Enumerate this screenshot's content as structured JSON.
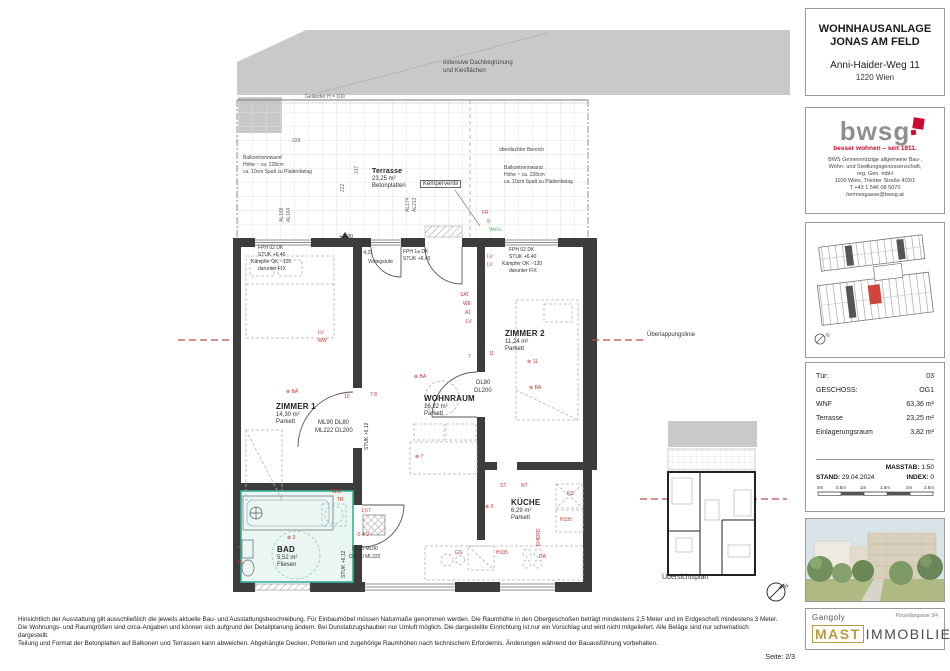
{
  "title_block": {
    "line1": "WOHNHAUSANLAGE",
    "line2": "JONAS AM FELD",
    "address1": "Anni-Haider-Weg 11",
    "address2": "1220 Wien"
  },
  "bwsg": {
    "logo_text": "bwsg",
    "tagline": "besser wohnen – seit 1911.",
    "desc1": "BWS Gemeinnützige allgemeine Bau-,",
    "desc2": "Wohn- und Siedlungsgenossenschaft,",
    "desc3": "reg. Gen. mbH",
    "desc4": "1100 Wien, Triester Straße 403/1",
    "desc5": "T +43 1 546 08 5070",
    "desc6": "hermesgasse@bwsg.at"
  },
  "unit_info": {
    "rows": [
      {
        "label": "Tür:",
        "value": "03"
      },
      {
        "label": "GESCHOSS:",
        "value": "OG1"
      },
      {
        "label": "WNF",
        "value": "63,36 m²"
      },
      {
        "label": "Terrasse",
        "value": "23,25 m²"
      },
      {
        "label": "Einlagerungsraum",
        "value": "3,82 m²"
      }
    ]
  },
  "plan_meta": {
    "masstab_label": "MASSTAB:",
    "masstab": "1:50",
    "stand_label": "STAND:",
    "stand": "29.04.2024",
    "index_label": "INDEX:",
    "index": "0",
    "scale_ticks": [
      "0m",
      "0.5m",
      "1m",
      "1.5m",
      "2m",
      "2.5m"
    ]
  },
  "brand": {
    "architect": "Gangoly",
    "address": "Porzellangasse 3/4",
    "brand_primary": "MAST",
    "brand_secondary": "IMMOBILIEN"
  },
  "rooms": [
    {
      "name": "ZIMMER 1",
      "area": "14,30 m²",
      "floor": "Parkett"
    },
    {
      "name": "WOHNRAUM",
      "area": "16,22 m²",
      "floor": "Parkett"
    },
    {
      "name": "ZIMMER 2",
      "area": "11,24 m²",
      "floor": "Parkett"
    },
    {
      "name": "KÜCHE",
      "area": "6,29 m²",
      "floor": "Parkett"
    },
    {
      "name": "BAD",
      "area": "5,52 m²",
      "floor": "Fliesen"
    },
    {
      "name": "Terrasse",
      "area": "23,25 m²",
      "floor": "Betonplatten"
    }
  ],
  "colors": {
    "annotation_red": "#c2382f",
    "overlap_red": "#bf4a44",
    "bad_teal": "#37b09c",
    "bwsg_red": "#cc0a2f",
    "mast_gold": "#b99a3e",
    "wall_dark": "#3c3c3c"
  },
  "plan": {
    "annotations": [
      {
        "t": "LV",
        "x": 487,
        "y": 254
      },
      {
        "t": "LV",
        "x": 487,
        "y": 262
      },
      {
        "t": "SAT",
        "x": 460,
        "y": 292
      },
      {
        "t": "WE",
        "x": 463,
        "y": 301
      },
      {
        "t": "A1",
        "x": 465,
        "y": 310
      },
      {
        "t": "LV",
        "x": 466,
        "y": 319
      },
      {
        "t": "LV",
        "x": 318,
        "y": 330
      },
      {
        "t": "MW",
        "x": 318,
        "y": 338
      },
      {
        "t": "⊗ BA",
        "x": 286,
        "y": 389
      },
      {
        "t": "10",
        "x": 344,
        "y": 394
      },
      {
        "t": "7 8",
        "x": 370,
        "y": 392
      },
      {
        "t": "⊗ BA",
        "x": 414,
        "y": 374
      },
      {
        "t": "⊗ 7",
        "x": 415,
        "y": 454
      },
      {
        "t": "7",
        "x": 468,
        "y": 354
      },
      {
        "t": "11",
        "x": 489,
        "y": 351
      },
      {
        "t": "⊗ 11",
        "x": 527,
        "y": 359
      },
      {
        "t": "⊗ BA",
        "x": 529,
        "y": 385
      },
      {
        "t": "ST",
        "x": 500,
        "y": 483
      },
      {
        "t": "NT",
        "x": 521,
        "y": 483
      },
      {
        "t": "KS",
        "x": 567,
        "y": 491
      },
      {
        "t": "H105",
        "x": 560,
        "y": 517
      },
      {
        "t": "EHERD",
        "x": 536,
        "y": 546,
        "v": true
      },
      {
        "t": "GS",
        "x": 455,
        "y": 550
      },
      {
        "t": "H105",
        "x": 496,
        "y": 550
      },
      {
        "t": "DA",
        "x": 539,
        "y": 554
      },
      {
        "t": "⊗ 6",
        "x": 485,
        "y": 504
      },
      {
        "t": "WM",
        "x": 332,
        "y": 489
      },
      {
        "t": "TR",
        "x": 337,
        "y": 497
      },
      {
        "t": "⊗ 3",
        "x": 287,
        "y": 535
      },
      {
        "t": "4",
        "x": 238,
        "y": 545
      },
      {
        "t": "KL",
        "x": 238,
        "y": 560
      },
      {
        "t": "1,67",
        "x": 361,
        "y": 508
      },
      {
        "t": "-0,4 V",
        "x": 356,
        "y": 532
      },
      {
        "t": "FR",
        "x": 482,
        "y": 210
      },
      {
        "t": "9",
        "x": 487,
        "y": 219
      },
      {
        "t": "Ven-L",
        "x": 489,
        "y": 227,
        "c": "#3aa544"
      },
      {
        "t": "FPH 02  DK",
        "x": 258,
        "y": 245,
        "c": "#333"
      },
      {
        "t": "STUK +6,40",
        "x": 258,
        "y": 252,
        "c": "#333"
      },
      {
        "t": "Kämpfer OK ~120",
        "x": 251,
        "y": 259,
        "c": "#333"
      },
      {
        "t": "darunter FIX",
        "x": 258,
        "y": 266,
        "c": "#333"
      },
      {
        "t": "FPH 1a  DK",
        "x": 403,
        "y": 249,
        "c": "#333"
      },
      {
        "t": "STUK +6,40",
        "x": 403,
        "y": 256,
        "c": "#333"
      },
      {
        "t": "FPH 02  DK",
        "x": 509,
        "y": 247,
        "c": "#333"
      },
      {
        "t": "STUK +6,40",
        "x": 509,
        "y": 254,
        "c": "#333"
      },
      {
        "t": "Kämpfer OK ~120",
        "x": 502,
        "y": 261,
        "c": "#333"
      },
      {
        "t": "darunter FIX",
        "x": 509,
        "y": 268,
        "c": "#333"
      },
      {
        "t": "+ 4,21",
        "x": 359,
        "y": 250,
        "c": "#333"
      },
      {
        "t": "Vorlegstufe",
        "x": 368,
        "y": 259,
        "c": "#333"
      },
      {
        "t": "+ 4,20",
        "x": 339,
        "y": 234,
        "c": "#333"
      },
      {
        "t": "ML90  DL80",
        "x": 318,
        "y": 420,
        "c": "#333",
        "fs": 6
      },
      {
        "t": "ML222  DL200",
        "x": 315,
        "y": 428,
        "c": "#333",
        "fs": 6
      },
      {
        "t": "STUK +6,12",
        "x": 364,
        "y": 450,
        "c": "#333",
        "v": true
      },
      {
        "t": "DL80",
        "x": 476,
        "y": 380,
        "c": "#333",
        "fs": 6
      },
      {
        "t": "DL200",
        "x": 474,
        "y": 388,
        "c": "#333",
        "fs": 6
      },
      {
        "t": "DL80  ML90",
        "x": 352,
        "y": 546,
        "c": "#333"
      },
      {
        "t": "DL200  ML222",
        "x": 349,
        "y": 554,
        "c": "#333"
      },
      {
        "t": "STUK +6,12",
        "x": 341,
        "y": 578,
        "c": "#333",
        "v": true
      },
      {
        "t": "Geländer H = 100",
        "x": 305,
        "y": 94,
        "c": "#555"
      },
      {
        "t": "überdachter Bereich",
        "x": 499,
        "y": 147,
        "c": "#444"
      },
      {
        "t": "Balkontrennwand",
        "x": 243,
        "y": 155,
        "c": "#444"
      },
      {
        "t": "Höhe ~ ca. 228cm",
        "x": 243,
        "y": 162,
        "c": "#444"
      },
      {
        "t": "ca. 10cm Spalt zu Plattenbelag",
        "x": 243,
        "y": 169,
        "c": "#444"
      },
      {
        "t": "Balkontrennwand",
        "x": 504,
        "y": 165,
        "c": "#444"
      },
      {
        "t": "Höhe ~ ca. 228cm",
        "x": 504,
        "y": 172,
        "c": "#444"
      },
      {
        "t": "ca. 10cm Spalt zu Plattenbelag",
        "x": 504,
        "y": 179,
        "c": "#444"
      },
      {
        "t": "extensive Dachbegrünung",
        "x": 443,
        "y": 60,
        "c": "#444",
        "fs": 6
      },
      {
        "t": "und Kiesflächen",
        "x": 443,
        "y": 68,
        "c": "#444",
        "fs": 6
      },
      {
        "t": "229",
        "x": 292,
        "y": 138,
        "c": "#666"
      },
      {
        "t": "222",
        "x": 340,
        "y": 192,
        "c": "#666",
        "v": true
      },
      {
        "t": "317",
        "x": 354,
        "y": 174,
        "c": "#666",
        "v": true
      },
      {
        "t": "AL168",
        "x": 279,
        "y": 222,
        "c": "#666",
        "v": true
      },
      {
        "t": "AL164",
        "x": 286,
        "y": 222,
        "c": "#666",
        "v": true
      },
      {
        "t": "AL174",
        "x": 405,
        "y": 212,
        "c": "#666",
        "v": true
      },
      {
        "t": "AL213",
        "x": 412,
        "y": 212,
        "c": "#666",
        "v": true
      },
      {
        "t": "Kemperventil",
        "x": 420,
        "y": 180,
        "c": "#333",
        "fs": 6,
        "box": true
      },
      {
        "t": "Überlappungslinie",
        "x": 647,
        "y": 332,
        "c": "#333",
        "fs": 6
      },
      {
        "t": "Übersichtsplan",
        "x": 662,
        "y": 575,
        "c": "#333",
        "fs": 7
      }
    ]
  },
  "disclaimer": {
    "line1": "Hinsichtlich der Ausstattung gilt ausschließlich die jeweils aktuelle Bau- und Ausstattungsbeschreibung. Für Einbaumöbel müssen Naturmaße genommen werden. Die Raumhöhe in den Obergeschoßen beträgt mindestens 2,5 Meter und im Erdgeschoß mindestens 3 Meter.",
    "line2": "Die Wohnungs- und Raumgrößen sind circa-Angaben und können sich aufgrund der Detailplanung ändern. Bei Dunstabzugshauben nur Umluft möglich. Die dargestellte Einrichtung ist nur ein Vorschlag und wird nicht mitgeliefert. Alle Beläge sind nur schematisch dargestellt.",
    "line3": "Teilung und Format der Betonplatten auf Balkonen und Terrassen kann abweichen. Abgehängte Decken, Potterien und zugehörige Raumhöhen nach technischem Erfordernis. Änderungen während der Bauausführung vorbehalten."
  },
  "page": {
    "seite": "Seite: 2/3"
  }
}
